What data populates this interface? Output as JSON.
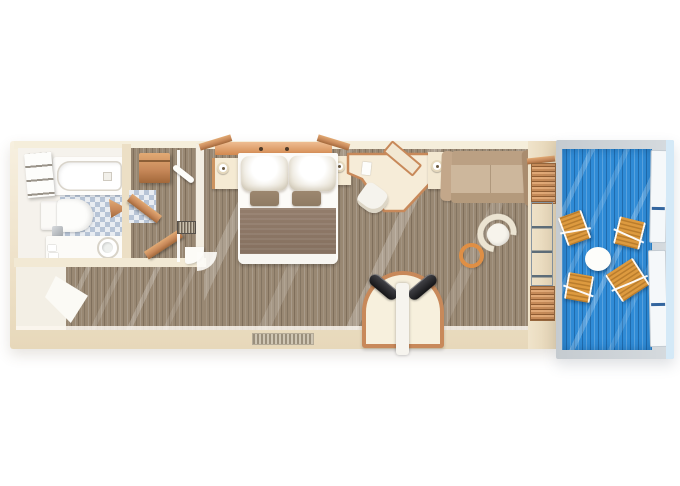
{
  "scene": {
    "name": "cabin-floor-plan",
    "view": "top-down",
    "description": "Rendered floor plan of a narrow cabin: bathroom, wardrobe and shower nook, entry hall, bedroom with double bed and desk, lounge with sofa, and a private balcony with deck furniture"
  },
  "colors": {
    "background": "#ffffff",
    "wall_cream": "#f2e8d4",
    "wall_dark": "#e6d7ba",
    "wood": "#c8895a",
    "wood_dark": "#a2683a",
    "wood_light": "#e2aa74",
    "headboard_orange": "#d3894f",
    "carpet": "#998873",
    "tile_blue": "#b7c4d6",
    "tile_light": "#e9edf2",
    "porcelain": "#fbfaf7",
    "bedspread": "#85705f",
    "accent_pillow": "#8f7b64",
    "sofa_tan": "#cdb79c",
    "sofa_dark": "#a98c6e",
    "armchair_cream": "#ece4d2",
    "table_ring_orange": "#df8f45",
    "cushion_black": "#151517",
    "deck_blue": "#2f8bd6",
    "deck_chair_wood": "#dd9a3f",
    "balcony_wall_gray": "#d6dbdf",
    "railing_white": "#f5f8fa",
    "railing_line_blue": "#33659e",
    "sea_light_blue": "#d4e9f7",
    "glass_gray": "#9fb2bd"
  },
  "rooms": [
    {
      "id": "bathroom",
      "furniture": [
        "bathtub",
        "shelf-unit",
        "toilet",
        "vanity-counter",
        "sink",
        "waste-bin",
        "tile-floor",
        "door-swing"
      ]
    },
    {
      "id": "wardrobe-dressing",
      "furniture": [
        "wall-cabinet",
        "shelf-plank-upper",
        "shelf-plank-lower",
        "tile-patch",
        "shower-wall",
        "shower-hook",
        "drain-grate",
        "door-arc"
      ]
    },
    {
      "id": "entry-hall",
      "furniture": [
        "entry-door",
        "carpet"
      ]
    },
    {
      "id": "bedroom",
      "furniture": [
        "double-bed",
        "pillow-left",
        "pillow-right",
        "accent-pillow-left",
        "accent-pillow-right",
        "bedspread",
        "headboard",
        "nightstand-left",
        "nightstand-right",
        "lamp-left",
        "lamp-right",
        "desk",
        "desk-mirror",
        "desk-chair",
        "vent-grille"
      ]
    },
    {
      "id": "lounge",
      "furniture": [
        "sofa",
        "armchair",
        "ring-table",
        "side-table",
        "side-table-lamp",
        "arch-loveseat",
        "black-cushions",
        "louver-screens",
        "glass-balcony-door"
      ]
    },
    {
      "id": "balcony",
      "furniture": [
        "blue-deck",
        "round-table",
        "deck-chair-1",
        "deck-chair-2",
        "deck-chair-3",
        "deck-chair-4",
        "railing-panels"
      ]
    }
  ],
  "counts": {
    "deck_chairs": 4,
    "bed_pillows": 2,
    "accent_pillows": 2
  }
}
